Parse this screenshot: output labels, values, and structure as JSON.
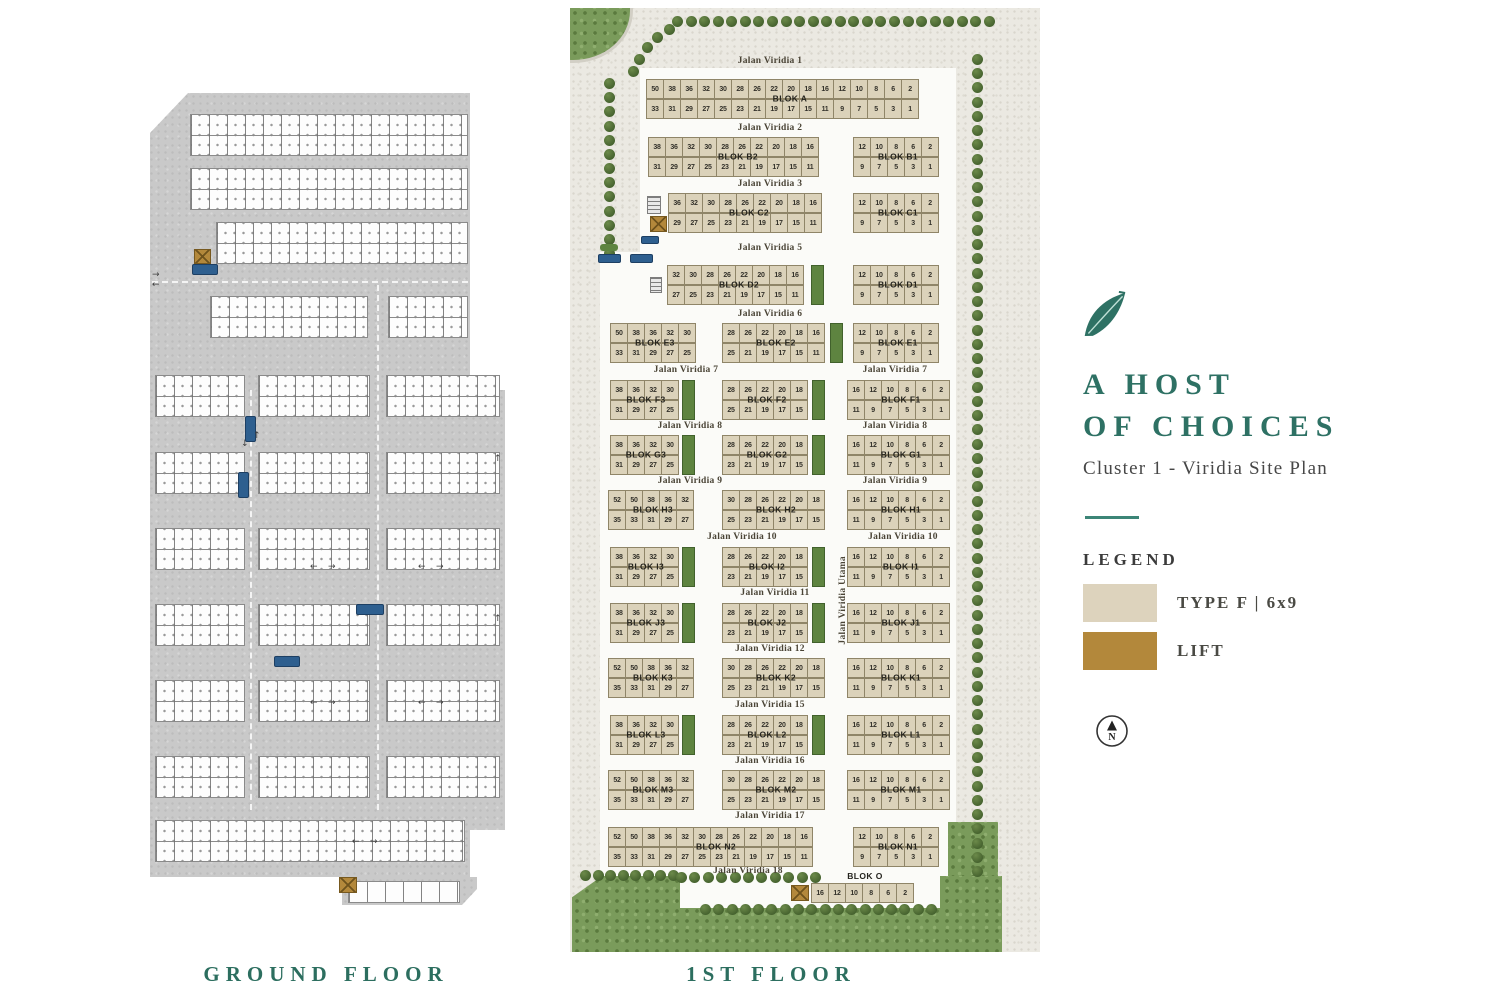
{
  "floors": {
    "ground_label": "GROUND FLOOR",
    "first_label": "1ST FLOOR"
  },
  "panel": {
    "title_line1": "A HOST",
    "title_line2": "OF CHOICES",
    "subtitle": "Cluster 1 - Viridia Site Plan",
    "legend_title": "LEGEND",
    "legend": [
      {
        "label": "TYPE F | 6x9",
        "color": "#ddd3bd"
      },
      {
        "label": "LIFT",
        "color": "#b3883b"
      }
    ],
    "compass_letter": "N",
    "icons": [
      "leaf-icon",
      "compass-north-icon"
    ]
  },
  "colors": {
    "accent": "#2c6e5f",
    "unit_fill": "#dbd2ba",
    "lift_fill": "#b3883b",
    "green_cell": "#5e8440"
  },
  "first_floor": {
    "roads": [
      {
        "label": "Jalan Viridia 1",
        "x": 770,
        "y": 56
      },
      {
        "label": "Jalan Viridia 2",
        "x": 770,
        "y": 123
      },
      {
        "label": "Jalan Viridia 3",
        "x": 770,
        "y": 179
      },
      {
        "label": "Jalan Viridia 5",
        "x": 770,
        "y": 243
      },
      {
        "label": "Jalan Viridia 6",
        "x": 770,
        "y": 309
      },
      {
        "label": "Jalan Viridia 7",
        "x": 686,
        "y": 365
      },
      {
        "label": "Jalan Viridia 7",
        "x": 895,
        "y": 365
      },
      {
        "label": "Jalan Viridia 8",
        "x": 690,
        "y": 421
      },
      {
        "label": "Jalan Viridia 8",
        "x": 895,
        "y": 421
      },
      {
        "label": "Jalan Viridia 9",
        "x": 690,
        "y": 476
      },
      {
        "label": "Jalan Viridia 9",
        "x": 895,
        "y": 476
      },
      {
        "label": "Jalan Viridia 10",
        "x": 742,
        "y": 532
      },
      {
        "label": "Jalan Viridia 10",
        "x": 903,
        "y": 532
      },
      {
        "label": "Jalan Viridia 11",
        "x": 775,
        "y": 588
      },
      {
        "label": "Jalan Viridia 12",
        "x": 770,
        "y": 644
      },
      {
        "label": "Jalan Viridia 15",
        "x": 770,
        "y": 700
      },
      {
        "label": "Jalan Viridia 16",
        "x": 770,
        "y": 756
      },
      {
        "label": "Jalan Viridia 17",
        "x": 770,
        "y": 811
      },
      {
        "label": "Jalan Viridia 18",
        "x": 748,
        "y": 866
      },
      {
        "label": "Jalan Viridia Utama",
        "x": 843,
        "y": 556,
        "vertical": true
      }
    ],
    "blocks": [
      {
        "name": "BLOK A",
        "x": 646,
        "y": 79,
        "top": [
          50,
          38,
          36,
          32,
          30,
          28,
          26,
          22,
          20,
          18,
          16,
          12,
          10,
          8,
          6,
          2
        ],
        "bottom": [
          33,
          31,
          29,
          27,
          25,
          23,
          21,
          19,
          17,
          15,
          11,
          9,
          7,
          5,
          3,
          1
        ]
      },
      {
        "name": "BLOK B2",
        "x": 648,
        "y": 137,
        "top": [
          38,
          36,
          32,
          30,
          28,
          26,
          22,
          20,
          18,
          16
        ],
        "bottom": [
          31,
          29,
          27,
          25,
          23,
          21,
          19,
          17,
          15,
          11
        ]
      },
      {
        "name": "BLOK B1",
        "x": 853,
        "y": 137,
        "top": [
          12,
          10,
          8,
          6,
          2
        ],
        "bottom": [
          9,
          7,
          5,
          3,
          1
        ]
      },
      {
        "name": "BLOK C2",
        "x": 668,
        "y": 193,
        "top": [
          36,
          32,
          30,
          28,
          26,
          22,
          20,
          18,
          16
        ],
        "bottom": [
          29,
          27,
          25,
          23,
          21,
          19,
          17,
          15,
          11
        ],
        "lift": "left-bottom"
      },
      {
        "name": "BLOK C1",
        "x": 853,
        "y": 193,
        "top": [
          12,
          10,
          8,
          6,
          2
        ],
        "bottom": [
          9,
          7,
          5,
          3,
          1
        ]
      },
      {
        "name": "BLOK D2",
        "x": 667,
        "y": 265,
        "top": [
          32,
          30,
          28,
          26,
          22,
          20,
          18,
          16
        ],
        "bottom": [
          27,
          25,
          23,
          21,
          19,
          17,
          15,
          11
        ],
        "green_end": true
      },
      {
        "name": "BLOK D1",
        "x": 853,
        "y": 265,
        "top": [
          12,
          10,
          8,
          6,
          2
        ],
        "bottom": [
          9,
          7,
          5,
          3,
          1
        ]
      },
      {
        "name": "BLOK E3",
        "x": 610,
        "y": 323,
        "top": [
          50,
          38,
          36,
          32,
          30
        ],
        "bottom": [
          33,
          31,
          29,
          27,
          25
        ]
      },
      {
        "name": "BLOK E2",
        "x": 722,
        "y": 323,
        "top": [
          28,
          26,
          22,
          20,
          18,
          16
        ],
        "bottom": [
          25,
          21,
          19,
          17,
          15,
          11
        ],
        "green_end": true
      },
      {
        "name": "BLOK E1",
        "x": 853,
        "y": 323,
        "top": [
          12,
          10,
          8,
          6,
          2
        ],
        "bottom": [
          9,
          7,
          5,
          3,
          1
        ]
      },
      {
        "name": "BLOK F3",
        "x": 610,
        "y": 380,
        "top": [
          38,
          36,
          32,
          30
        ],
        "bottom": [
          31,
          29,
          27,
          25
        ],
        "green_end": true
      },
      {
        "name": "BLOK F2",
        "x": 722,
        "y": 380,
        "top": [
          28,
          26,
          22,
          20,
          18
        ],
        "bottom": [
          25,
          21,
          19,
          17,
          15
        ],
        "green_end": true
      },
      {
        "name": "BLOK F1",
        "x": 847,
        "y": 380,
        "top": [
          16,
          12,
          10,
          8,
          6,
          2
        ],
        "bottom": [
          11,
          9,
          7,
          5,
          3,
          1
        ]
      },
      {
        "name": "BLOK G3",
        "x": 610,
        "y": 435,
        "top": [
          38,
          36,
          32,
          30
        ],
        "bottom": [
          31,
          29,
          27,
          25
        ],
        "green_end": true
      },
      {
        "name": "BLOK G2",
        "x": 722,
        "y": 435,
        "top": [
          28,
          26,
          22,
          20,
          18
        ],
        "bottom": [
          23,
          21,
          19,
          17,
          15
        ],
        "green_end": true
      },
      {
        "name": "BLOK G1",
        "x": 847,
        "y": 435,
        "top": [
          16,
          12,
          10,
          8,
          6,
          2
        ],
        "bottom": [
          11,
          9,
          7,
          5,
          3,
          1
        ]
      },
      {
        "name": "BLOK H3",
        "x": 608,
        "y": 490,
        "top": [
          52,
          50,
          38,
          36,
          32
        ],
        "bottom": [
          35,
          33,
          31,
          29,
          27
        ]
      },
      {
        "name": "BLOK H2",
        "x": 722,
        "y": 490,
        "top": [
          30,
          28,
          26,
          22,
          20,
          18
        ],
        "bottom": [
          25,
          23,
          21,
          19,
          17,
          15
        ]
      },
      {
        "name": "BLOK H1",
        "x": 847,
        "y": 490,
        "top": [
          16,
          12,
          10,
          8,
          6,
          2
        ],
        "bottom": [
          11,
          9,
          7,
          5,
          3,
          1
        ]
      },
      {
        "name": "BLOK I3",
        "x": 610,
        "y": 547,
        "top": [
          38,
          36,
          32,
          30
        ],
        "bottom": [
          31,
          29,
          27,
          25
        ],
        "green_end": true
      },
      {
        "name": "BLOK I2",
        "x": 722,
        "y": 547,
        "top": [
          28,
          26,
          22,
          20,
          18
        ],
        "bottom": [
          23,
          21,
          19,
          17,
          15
        ],
        "green_end": true
      },
      {
        "name": "BLOK I1",
        "x": 847,
        "y": 547,
        "top": [
          16,
          12,
          10,
          8,
          6,
          2
        ],
        "bottom": [
          11,
          9,
          7,
          5,
          3,
          1
        ]
      },
      {
        "name": "BLOK J3",
        "x": 610,
        "y": 603,
        "top": [
          38,
          36,
          32,
          30
        ],
        "bottom": [
          31,
          29,
          27,
          25
        ],
        "green_end": true
      },
      {
        "name": "BLOK J2",
        "x": 722,
        "y": 603,
        "top": [
          28,
          26,
          22,
          20,
          18
        ],
        "bottom": [
          23,
          21,
          19,
          17,
          15
        ],
        "green_end": true
      },
      {
        "name": "BLOK J1",
        "x": 847,
        "y": 603,
        "top": [
          16,
          12,
          10,
          8,
          6,
          2
        ],
        "bottom": [
          11,
          9,
          7,
          5,
          3,
          1
        ]
      },
      {
        "name": "BLOK K3",
        "x": 608,
        "y": 658,
        "top": [
          52,
          50,
          38,
          36,
          32
        ],
        "bottom": [
          35,
          33,
          31,
          29,
          27
        ]
      },
      {
        "name": "BLOK K2",
        "x": 722,
        "y": 658,
        "top": [
          30,
          28,
          26,
          22,
          20,
          18
        ],
        "bottom": [
          25,
          23,
          21,
          19,
          17,
          15
        ]
      },
      {
        "name": "BLOK K1",
        "x": 847,
        "y": 658,
        "top": [
          16,
          12,
          10,
          8,
          6,
          2
        ],
        "bottom": [
          11,
          9,
          7,
          5,
          3,
          1
        ]
      },
      {
        "name": "BLOK L3",
        "x": 610,
        "y": 715,
        "top": [
          38,
          36,
          32,
          30
        ],
        "bottom": [
          31,
          29,
          27,
          25
        ],
        "green_end": true
      },
      {
        "name": "BLOK L2",
        "x": 722,
        "y": 715,
        "top": [
          28,
          26,
          22,
          20,
          18
        ],
        "bottom": [
          23,
          21,
          19,
          17,
          15
        ],
        "green_end": true
      },
      {
        "name": "BLOK L1",
        "x": 847,
        "y": 715,
        "top": [
          16,
          12,
          10,
          8,
          6,
          2
        ],
        "bottom": [
          11,
          9,
          7,
          5,
          3,
          1
        ]
      },
      {
        "name": "BLOK M3",
        "x": 608,
        "y": 770,
        "top": [
          52,
          50,
          38,
          36,
          32
        ],
        "bottom": [
          35,
          33,
          31,
          29,
          27
        ]
      },
      {
        "name": "BLOK M2",
        "x": 722,
        "y": 770,
        "top": [
          30,
          28,
          26,
          22,
          20,
          18
        ],
        "bottom": [
          25,
          23,
          21,
          19,
          17,
          15
        ]
      },
      {
        "name": "BLOK M1",
        "x": 847,
        "y": 770,
        "top": [
          16,
          12,
          10,
          8,
          6,
          2
        ],
        "bottom": [
          11,
          9,
          7,
          5,
          3,
          1
        ]
      },
      {
        "name": "BLOK N2",
        "x": 608,
        "y": 827,
        "top": [
          52,
          50,
          38,
          36,
          32,
          30,
          28,
          26,
          22,
          20,
          18,
          16
        ],
        "bottom": [
          35,
          33,
          31,
          29,
          27,
          25,
          23,
          21,
          19,
          17,
          15,
          11
        ]
      },
      {
        "name": "BLOK N1",
        "x": 853,
        "y": 827,
        "top": [
          12,
          10,
          8,
          6,
          2
        ],
        "bottom": [
          9,
          7,
          5,
          3,
          1
        ]
      },
      {
        "name": "BLOK O",
        "x": 811,
        "y": 883,
        "top": [
          16,
          12,
          10,
          8,
          6,
          2
        ],
        "lift": "left",
        "label_above": true
      }
    ]
  }
}
